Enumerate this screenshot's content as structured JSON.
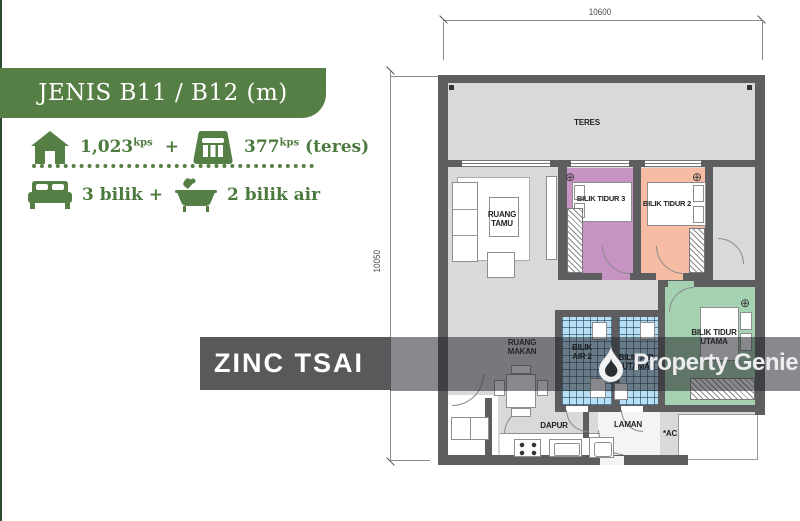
{
  "panel": {
    "title": "JENIS B11 / B12 (m)",
    "area_main": "1,023",
    "area_main_sup": "kps",
    "plus": "+",
    "area_teres": "377",
    "area_teres_sup": "kps",
    "area_teres_suffix": " (teres)",
    "bedrooms": "3 bilik +",
    "bathrooms": "2 bilik air"
  },
  "dimensions": {
    "top": "10600",
    "left": "10050"
  },
  "rooms": {
    "teres": "TERES",
    "ruang_tamu": [
      "RUANG",
      "TAMU"
    ],
    "bilik_tidur_3": "BILIK TIDUR 3",
    "bilik_tidur_2": "BILIK TIDUR 2",
    "bilik_tidur_utama": [
      "BILIK TIDUR",
      "UTAMA"
    ],
    "bilik_air_2": [
      "BILIK",
      "AIR 2"
    ],
    "bilik_air_utama": [
      "BILIK AIR",
      "UTAMA"
    ],
    "ruang_makan": [
      "RUANG",
      "MAKAN"
    ],
    "dapur": "DAPUR",
    "laman": "LAMAN",
    "ac": "*AC"
  },
  "watermarks": {
    "left": "ZINC TSAI",
    "right": "Property Genie"
  },
  "colors": {
    "brand_green": "#567f45",
    "edge_green": "#2e4b2e",
    "wall_gray": "#5e5e60",
    "floor_gray": "#d9d9db",
    "bilik3_purple": "#c693c3",
    "bilik2_salmon": "#f7bca4",
    "utama_green": "#a5d2b0",
    "bath_blue": "#b9e0f2",
    "zinc_band": "#59595b"
  }
}
